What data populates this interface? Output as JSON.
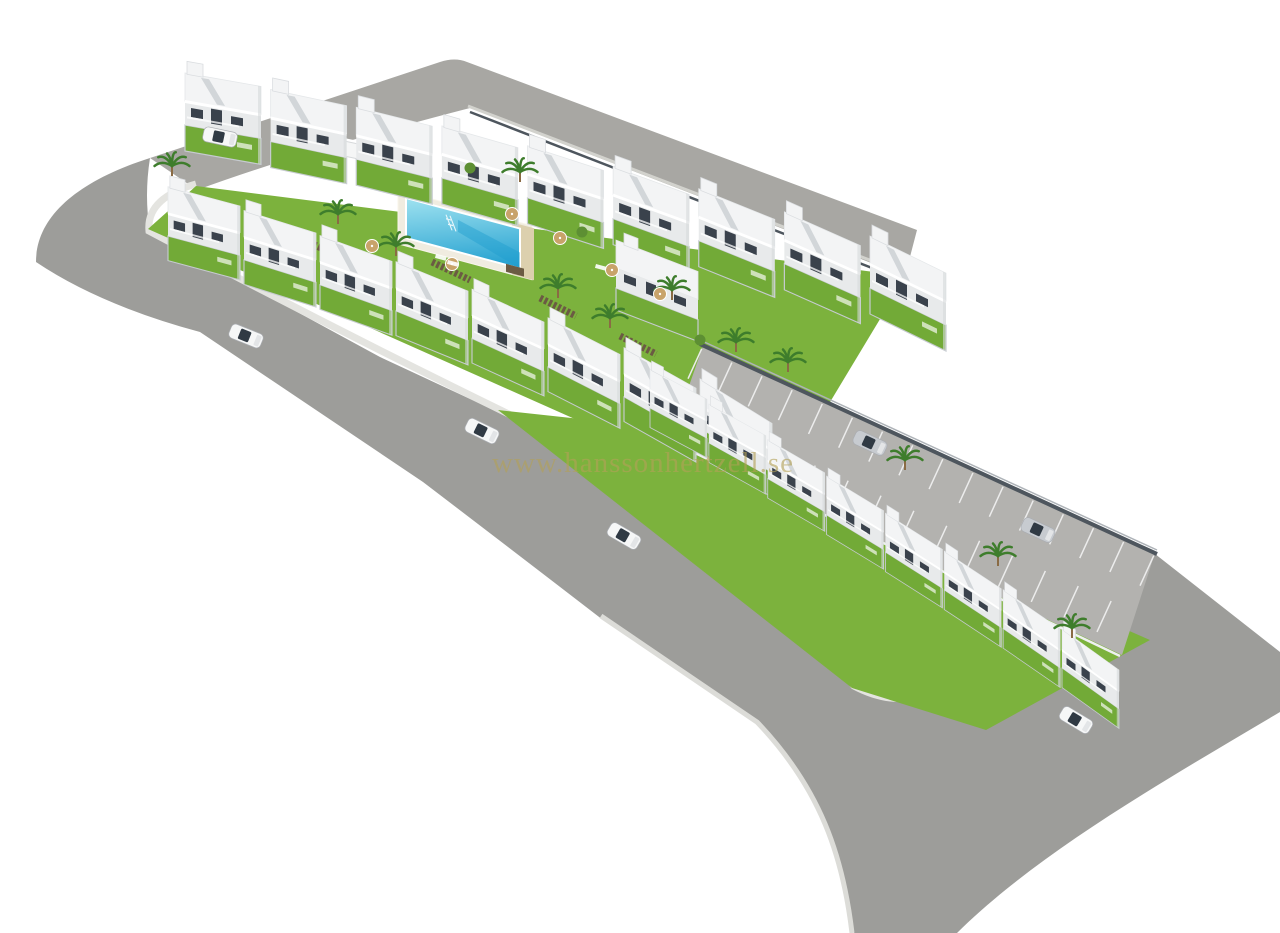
{
  "scene": {
    "type": "3d-architectural-render",
    "description": "Aerial 3D visualization of an L-shaped residential development of white two-storey townhouses with roof terraces, private gardens, a communal pool courtyard, an angled parking strip and wide grey perimeter roads on a white background",
    "background": "#ffffff"
  },
  "watermark": {
    "text": "www.hanssonhertzell.se",
    "color": "#b3a158",
    "opacity": 0.62
  },
  "palette": {
    "road": "#9d9d9a",
    "road_light": "#a8a7a3",
    "parking": "#b3b2af",
    "sidewalk": "#e4e4e0",
    "curb": "#d2d2cd",
    "lawn": "#7cb23d",
    "garden": "#72aa37",
    "pool_water_light": "#9fe2f0",
    "pool_water_dark": "#1f9ecf",
    "pool_deck": "#f0ece0",
    "pool_stone": "#dcd0ae",
    "house_roof": "#f3f4f5",
    "house_face": "#e8eaeb",
    "house_side": "#d6d9db",
    "window": "#3a424c",
    "stair": "#d2d6d9",
    "wall_dark": "#4e565e",
    "fence": "#c6cbd0",
    "walkway": "#6b5b43",
    "car_white": "#f6f7f7",
    "car_silver": "#c7cbd0",
    "glass": "#303a44",
    "palm": "#3e7d2c",
    "bush": "#5d8f33",
    "parasol": "#c8a36a"
  },
  "site": {
    "rows": [
      {
        "name": "north-row",
        "units": 9
      },
      {
        "name": "middle-row",
        "units": 8
      },
      {
        "name": "east-wing-row",
        "units": 8
      }
    ],
    "detached_buildings": 1,
    "community_box": 1,
    "pool": {
      "main_pool": 1,
      "kids_pool": 1,
      "ladder": 1
    },
    "palm_trees": 12,
    "bushes": 3,
    "parasols": 6,
    "sun_loungers": 3,
    "walkway_strips": 4,
    "parking": {
      "stripes_front": 16,
      "stripes_back": 12,
      "parked_cars": 2
    },
    "cars_on_roads": 4,
    "cars_on_driveway": 1
  }
}
